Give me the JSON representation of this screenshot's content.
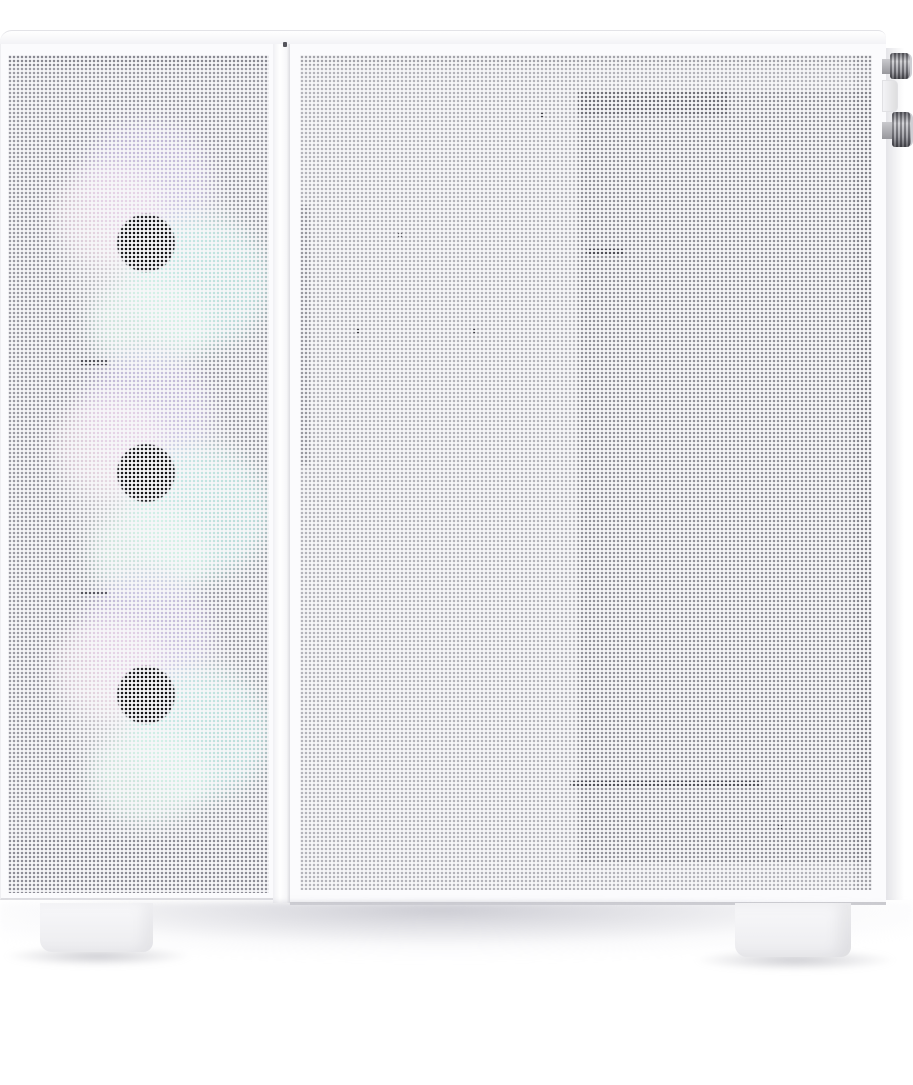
{
  "scene": {
    "alt": "Product photo of a white mini-tower PC case with perforated square-hole mesh front and side panels, three RGB fans glowing softly in lavender, pink, cyan and mint behind the front mesh, two knurled metal thumbscrews and a white latch tab on the right edge, and white case feet casting a soft shadow on a white studio background."
  },
  "product": {
    "category": "desktop-pc-case",
    "finish": "snow white",
    "front_panel": "perforated square-hole mesh",
    "side_panel": "perforated square-hole mesh",
    "visible_fan_count": 3,
    "visible_thumbscrew_count": 2,
    "visible_feet_count": 2
  },
  "fans": [
    {
      "name": "front-fan-top",
      "hub": "black center hub",
      "led_tints": [
        "lavender",
        "pink",
        "cyan",
        "mint"
      ]
    },
    {
      "name": "front-fan-middle",
      "hub": "black center hub",
      "led_tints": [
        "lavender",
        "pink",
        "cyan",
        "mint"
      ]
    },
    {
      "name": "front-fan-bottom",
      "hub": "black center hub",
      "led_tints": [
        "lavender",
        "pink",
        "cyan",
        "mint"
      ]
    }
  ],
  "hardware": {
    "thumbscrews": [
      {
        "name": "side-panel-thumbscrew-upper"
      },
      {
        "name": "side-panel-thumbscrew-lower"
      }
    ],
    "latch_tab": "white hinge tab between thumbscrews"
  },
  "colors": {
    "case_white": "#f6f6f8",
    "panel_white": "#fbfbfd",
    "mesh_underlay": "#9a9aa2",
    "mesh_underlay_light": "#b2b2b9",
    "mesh_underlay_dark": "#8a8a92",
    "fan_hub": "#101013",
    "glow_lavender": "#cfc3e8",
    "glow_pink": "#f3dcea",
    "glow_cyan": "#c2ebe6",
    "glow_mint": "#d8f4e9",
    "screw_metal_dark": "#64646a",
    "screw_metal_light": "#c2c2c7",
    "seam_line": "#dcdce0",
    "shadow_tint": "#cdcdd4",
    "foot_white": "#f8f8fa"
  }
}
